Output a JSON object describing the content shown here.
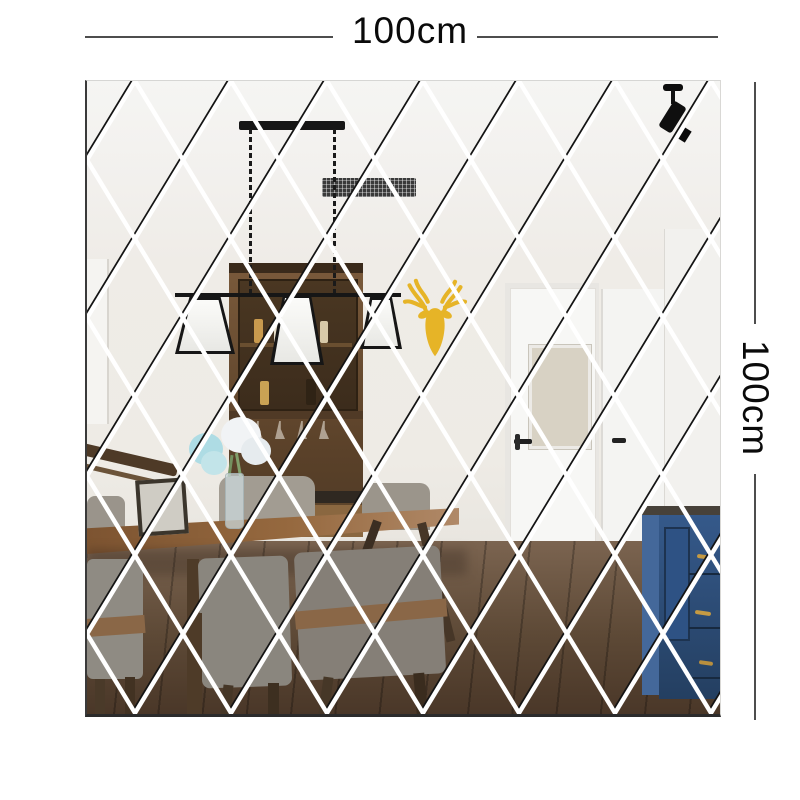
{
  "product": {
    "name": "diamond mirror wall sticker",
    "width_label": "100cm",
    "height_label": "100cm"
  },
  "scene": {
    "objects": [
      "ceiling-vent",
      "track-spotlight",
      "pendant-chandelier",
      "gold-deer-head",
      "wood-display-hutch",
      "flower-vase",
      "photo-frame",
      "stair-handrail",
      "white-interior-door",
      "second-white-door",
      "navy-drawer-cabinet",
      "dining-table",
      "gray-dining-chairs",
      "dark-wood-floor"
    ],
    "colors": {
      "seam_white": "#ffffff",
      "seam_dark": "#141414",
      "dimension_line": "#4d4d4d",
      "label_text": "#0a0a0a",
      "deer_gold": "#e6b427",
      "cabinet_navy": "#2e5284",
      "table_wood": "#8f6239",
      "floor_wood": "#5d4a38",
      "chair_gray": "#8f8b83",
      "hutch_wood": "#6b4d31"
    }
  }
}
